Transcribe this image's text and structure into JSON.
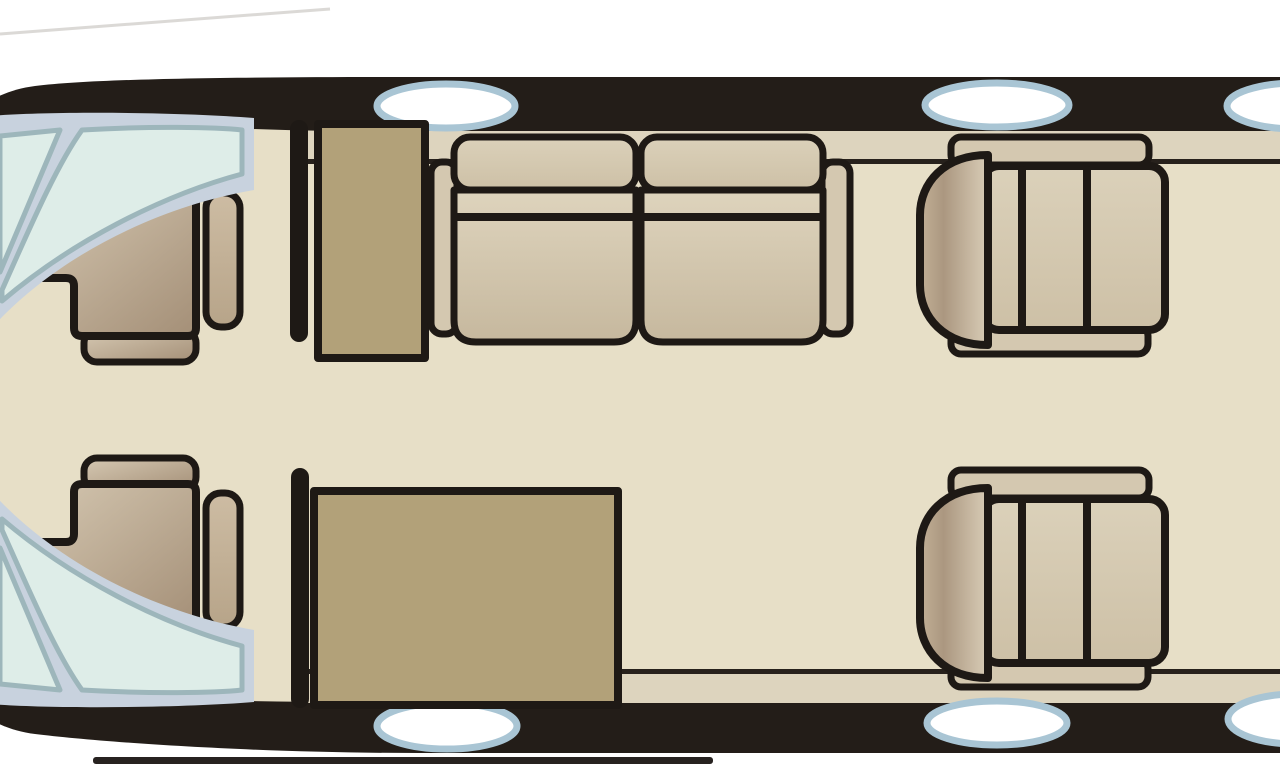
{
  "scene": {
    "description": "Top-down floor plan of a business jet cabin interior",
    "furniture_inventory": [
      "pilot-seat-upper",
      "pilot-seat-lower",
      "forward-cabinet",
      "two-seat-divan",
      "aft-cabinet",
      "club-seat-forward",
      "club-seat-aft"
    ],
    "window_count_top": 3,
    "window_count_bottom": 3,
    "windshield_pane_count": 4
  },
  "colors": {
    "background": "#ffffff",
    "fuselage": "#231d18",
    "outline": "#1e1915",
    "floor": "#e7dfc7",
    "sidewall": "#ddd4be",
    "wall_line": "#27211c",
    "cabinet": "#b2a179",
    "seat_light": "#ded4bd",
    "seat_mid": "#c6b89e",
    "body_light": "#dbd1ba",
    "body_mid": "#cdc0a6",
    "armrest": "#d4c8b0",
    "d_edge": "#c2b096",
    "d_dark": "#ab9780",
    "d_light": "#d9cdb7",
    "pilot_light": "#d6c9b3",
    "pilot_dark": "#a48f77",
    "pilot_head_light": "#cdbca3",
    "pilot_head_dark": "#b7a489",
    "window_fill": "#ffffff",
    "window_ring": "#a9c5d4",
    "windshield_frame": "#c8d2de",
    "windshield_pane": "#deede8",
    "windshield_mullion": "#9db6bb",
    "shadow_line": "#272220",
    "decor_line": "#d2d0cc"
  }
}
